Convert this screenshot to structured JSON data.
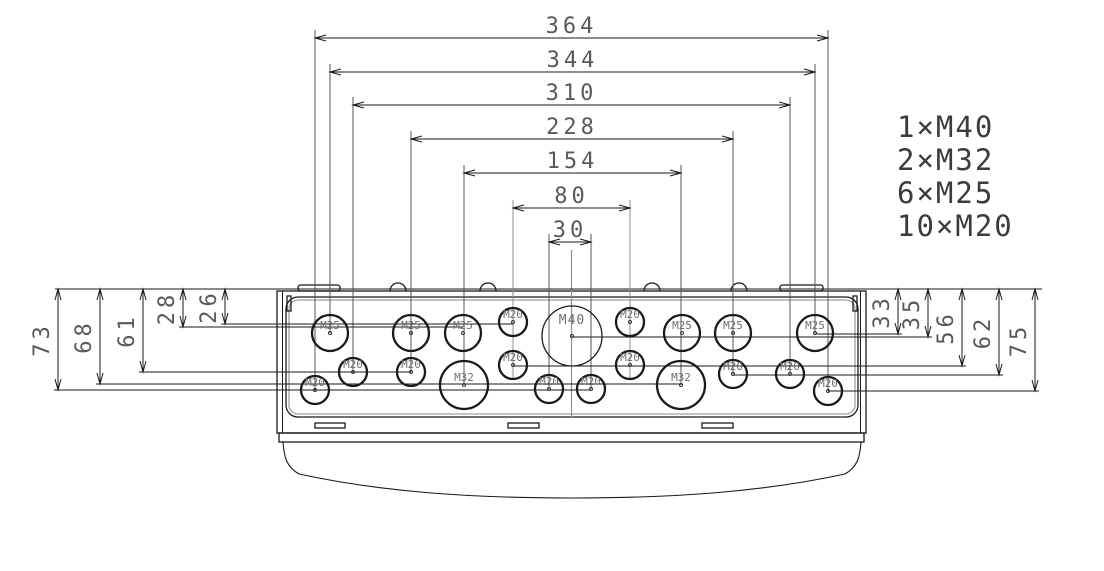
{
  "drawing": {
    "canvas": {
      "width": 1104,
      "height": 571,
      "background": "#ffffff"
    },
    "colors": {
      "line": "#1a1a1a",
      "ext_line": "#555555",
      "gray_construction": "#8f8f8f",
      "dim_text": "#595959",
      "label_text": "#6e6e6e",
      "legend_text": "#3c3c3c",
      "inner_gray_edge": "#b0b0b0",
      "dot": "#333333"
    },
    "legend": {
      "x": 897,
      "baseline_start": 137,
      "line_height": 33,
      "font_size": 29,
      "items": [
        "1×M40",
        "2×M32",
        "6×M25",
        "10×M20"
      ]
    },
    "top_reference_line": {
      "y": 289,
      "x1": 55,
      "x2": 1042
    },
    "horizontal_dims": [
      {
        "label": "364",
        "y": 38,
        "x1": 315,
        "x2": 828,
        "drop1": 390,
        "drop2": 391
      },
      {
        "label": "344",
        "y": 72,
        "x1": 330,
        "x2": 815,
        "drop1": 333,
        "drop2": 333
      },
      {
        "label": "310",
        "y": 105,
        "x1": 353,
        "x2": 790,
        "drop1": 372,
        "drop2": 374
      },
      {
        "label": "228",
        "y": 139,
        "x1": 411,
        "x2": 733,
        "drop1": 372,
        "drop2": 374
      },
      {
        "label": "154",
        "y": 173,
        "x1": 464,
        "x2": 681,
        "drop1": 385,
        "drop2": 385
      },
      {
        "label": "80",
        "y": 208,
        "x1": 513,
        "x2": 630,
        "drop1": 378,
        "drop2": 378,
        "gray_ext": true
      },
      {
        "label": "30",
        "y": 242,
        "x1": 549,
        "x2": 591,
        "drop1": 389,
        "drop2": 389
      }
    ],
    "left_dims": [
      {
        "label": "73",
        "x": 58,
        "y_top": 289,
        "y_bottom": 390,
        "feature_x": 591
      },
      {
        "label": "68",
        "x": 100,
        "y_top": 289,
        "y_bottom": 384,
        "feature_x": 681
      },
      {
        "label": "61",
        "x": 143,
        "y_top": 289,
        "y_bottom": 372,
        "feature_x": 411
      },
      {
        "label": "28",
        "x": 183,
        "y_top": 289,
        "y_bottom": 327,
        "feature_x": 463
      },
      {
        "label": "26",
        "x": 225,
        "y_top": 289,
        "y_bottom": 324,
        "feature_x": 513
      }
    ],
    "right_dims": [
      {
        "label": "33",
        "x": 898,
        "y_top": 289,
        "y_bottom": 334,
        "feature_x": 815
      },
      {
        "label": "35",
        "x": 928,
        "y_top": 289,
        "y_bottom": 337,
        "feature_x": 572
      },
      {
        "label": "56",
        "x": 962,
        "y_top": 289,
        "y_bottom": 366,
        "feature_x": 513
      },
      {
        "label": "62",
        "x": 999,
        "y_top": 289,
        "y_bottom": 375,
        "feature_x": 733
      },
      {
        "label": "75",
        "x": 1035,
        "y_top": 289,
        "y_bottom": 391,
        "feature_x": 828
      }
    ],
    "centerline": {
      "x": 571.5,
      "y1": 250,
      "y2": 418
    },
    "knockouts": [
      {
        "label": "M25",
        "cx": 330,
        "cy": 333,
        "r": 18
      },
      {
        "label": "M25",
        "cx": 411,
        "cy": 333,
        "r": 18
      },
      {
        "label": "M25",
        "cx": 463,
        "cy": 333,
        "r": 18
      },
      {
        "label": "M20",
        "cx": 513,
        "cy": 322,
        "r": 14
      },
      {
        "label": "M40",
        "cx": 572,
        "cy": 336,
        "r": 30
      },
      {
        "label": "M20",
        "cx": 630,
        "cy": 322,
        "r": 14
      },
      {
        "label": "M25",
        "cx": 682,
        "cy": 333,
        "r": 18
      },
      {
        "label": "M25",
        "cx": 733,
        "cy": 333,
        "r": 18
      },
      {
        "label": "M25",
        "cx": 815,
        "cy": 333,
        "r": 18
      },
      {
        "label": "M20",
        "cx": 353,
        "cy": 372,
        "r": 14
      },
      {
        "label": "M20",
        "cx": 411,
        "cy": 372,
        "r": 14
      },
      {
        "label": "M32",
        "cx": 464,
        "cy": 385,
        "r": 24
      },
      {
        "label": "M20",
        "cx": 513,
        "cy": 365,
        "r": 14
      },
      {
        "label": "M20",
        "cx": 630,
        "cy": 365,
        "r": 14
      },
      {
        "label": "M32",
        "cx": 681,
        "cy": 385,
        "r": 24
      },
      {
        "label": "M20",
        "cx": 733,
        "cy": 374,
        "r": 14
      },
      {
        "label": "M20",
        "cx": 790,
        "cy": 374,
        "r": 14
      },
      {
        "label": "M20",
        "cx": 315,
        "cy": 390,
        "r": 14
      },
      {
        "label": "M20",
        "cx": 549,
        "cy": 389,
        "r": 14
      },
      {
        "label": "M20",
        "cx": 591,
        "cy": 389,
        "r": 14
      },
      {
        "label": "M20",
        "cx": 828,
        "cy": 391,
        "r": 14
      }
    ],
    "enclosure": {
      "outer": {
        "x": 277,
        "y": 291,
        "w": 589,
        "h": 142
      },
      "inner_edge_x": [
        282.5,
        860.5
      ],
      "inner_rect": {
        "x": 286,
        "y": 297,
        "w": 572,
        "h": 120,
        "r": 12
      },
      "inner_gray_rect": {
        "x": 289,
        "y": 300,
        "w": 566,
        "h": 114,
        "r": 9
      },
      "corner_slots": [
        {
          "x": 287,
          "y": 296,
          "w": 4,
          "h": 15
        },
        {
          "x": 853,
          "y": 296,
          "w": 4,
          "h": 15
        }
      ],
      "top_tabs": [
        {
          "x": 298,
          "y": 285,
          "w": 42,
          "h": 6
        },
        {
          "x": 780,
          "y": 285,
          "w": 43,
          "h": 6
        }
      ],
      "top_bumps": {
        "r": 8,
        "cy": 291,
        "centers": [
          398,
          488,
          652,
          739
        ]
      },
      "band": {
        "x": 279,
        "y": 433,
        "w": 585,
        "h": 9
      },
      "recesses": [
        {
          "x": 315,
          "y": 423,
          "w": 30,
          "h": 5
        },
        {
          "x": 508,
          "y": 423,
          "w": 31,
          "h": 5
        },
        {
          "x": 702,
          "y": 423,
          "w": 31,
          "h": 5
        }
      ],
      "skirt_path": "M283,442 C284,458 287,467 299,474 C382,492 470,498 572,498 C674,498 762,492 845,474 C857,467 860,458 861,442"
    }
  }
}
